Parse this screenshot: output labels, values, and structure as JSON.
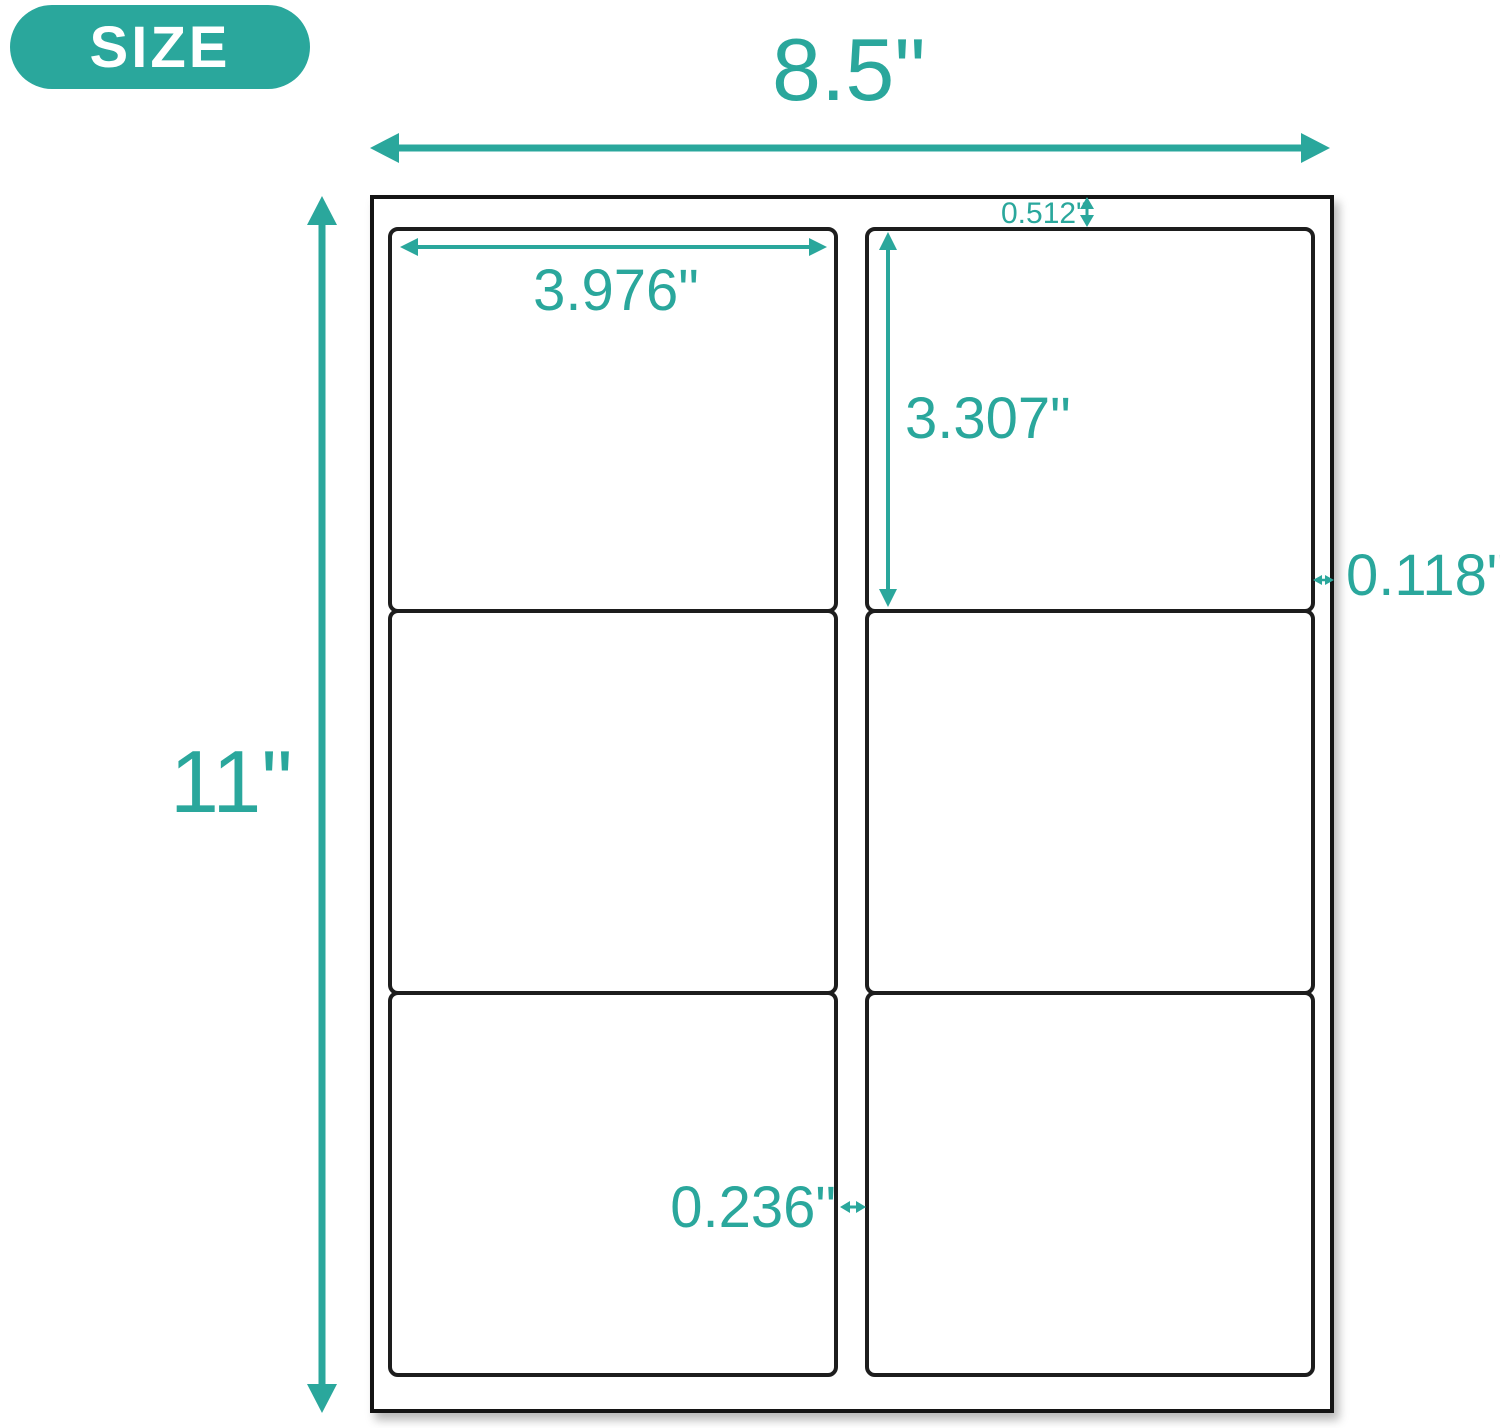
{
  "accent_color": "#2aa79c",
  "sheet_border_color": "#141414",
  "label_border_color": "#1d1d1d",
  "badge": {
    "label": "SIZE"
  },
  "sheet": {
    "rows": 3,
    "columns": 2,
    "label_count": 6
  },
  "dimensions": {
    "sheet_width": "8.5\"",
    "sheet_height": "11\"",
    "label_width": "3.976\"",
    "label_height": "3.307\"",
    "top_margin": "0.512\"",
    "right_margin": "0.118\"",
    "column_gap": "0.236\""
  }
}
